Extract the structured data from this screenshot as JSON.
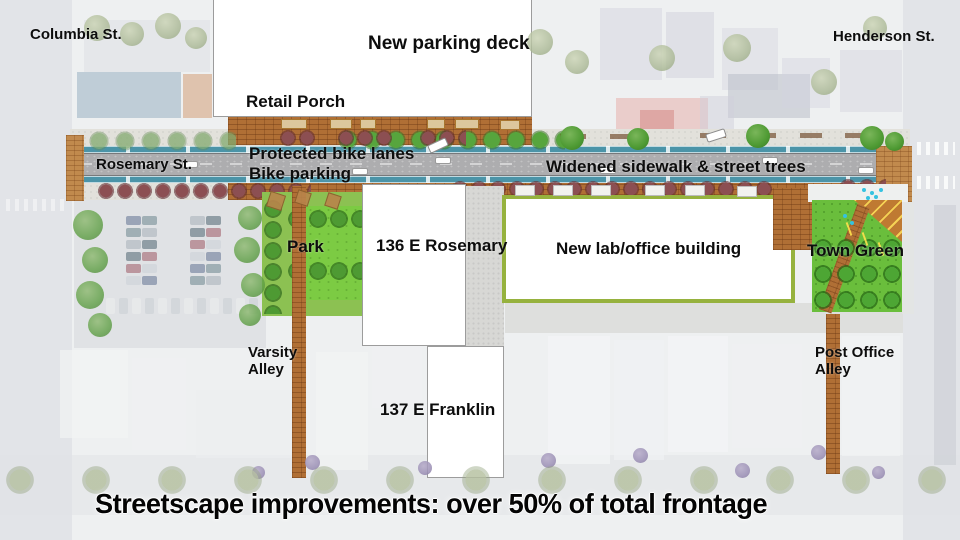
{
  "labels": {
    "columbia": "Columbia St.",
    "henderson": "Henderson St.",
    "rosemary": "Rosemary St.",
    "parking_deck": "New parking deck",
    "retail_porch": "Retail Porch",
    "protected_bike_lanes": "Protected bike lanes",
    "bike_parking": "Bike parking",
    "widened_sidewalk": "Widened sidewalk & street trees",
    "park": "Park",
    "building_136": "136 E Rosemary",
    "lab_building": "New lab/office building",
    "town_green": "Town Green",
    "varsity_alley_line1": "Varsity",
    "varsity_alley_line2": "Alley",
    "post_office_alley_line1": "Post Office",
    "post_office_alley_line2": "Alley",
    "building_137": "137 E Franklin"
  },
  "caption": "Streetscape improvements: over 50% of total frontage",
  "colors": {
    "bike_lane_teal": "#4b94a8",
    "asphalt_gray": "#adadaf",
    "brick_paving": "#b06f35",
    "lawn_green": "#7ccb43",
    "hedge_green": "#96b23e",
    "street_tree_green": "#55a23c",
    "street_tree_maroon": "#8c4f52",
    "label_black": "#0d0d0d"
  }
}
